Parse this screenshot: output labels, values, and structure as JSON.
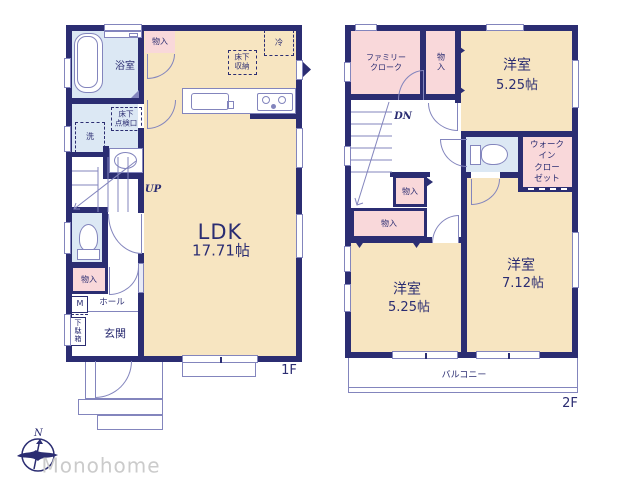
{
  "colors": {
    "wall": "#2b2d72",
    "room": "#f7e5c1",
    "closet": "#f9d8da",
    "wet": "#dce8f4",
    "line": "#8385bd",
    "brand_text": "#cbcbcb"
  },
  "f1": {
    "label": "1F",
    "bathroom": "浴室",
    "closet_a": "物入",
    "fridge": "冷",
    "underfloor_storage": [
      "床下",
      "収納"
    ],
    "underfloor_hatch": [
      "床下",
      "点検口"
    ],
    "laundry": "洗",
    "stairs": "UP",
    "ldk": "LDK",
    "ldk_size": "17.71帖",
    "closet_b": "物入",
    "meter": "M",
    "hall": "ホール",
    "shoe_cabinet": [
      "下",
      "駄",
      "箱"
    ],
    "entrance": "玄関"
  },
  "f2": {
    "label": "2F",
    "family_cloak": [
      "ファミリー",
      "クローク"
    ],
    "closet_a": [
      "物",
      "入"
    ],
    "bedroom_a": "洋室",
    "bedroom_a_size": "5.25帖",
    "stairs": "DN",
    "walk_in_closet": [
      "ウォーク",
      "イン",
      "クロー",
      "ゼット"
    ],
    "closet_b": "物入",
    "closet_c": "物入",
    "bedroom_b": "洋室",
    "bedroom_b_size": "5.25帖",
    "bedroom_c": "洋室",
    "bedroom_c_size": "7.12帖",
    "balcony": "バルコニー"
  },
  "brand": {
    "name": "Monohome",
    "north": "N"
  }
}
